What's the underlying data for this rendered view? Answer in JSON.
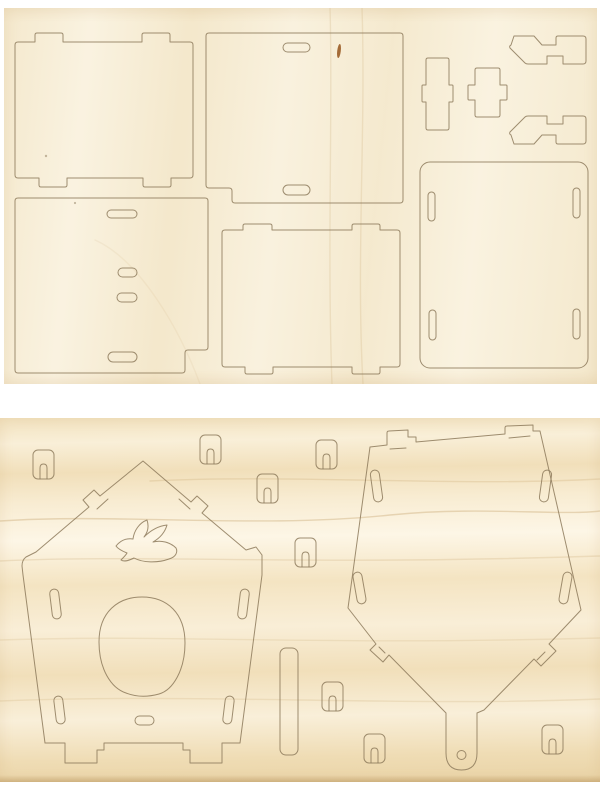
{
  "scene": {
    "type": "product-photo",
    "subject": "Laser-cut plywood birdhouse craft kit: two wooden punch-out sheets photographed on white",
    "sheet_count": 2,
    "visible_text": ""
  },
  "colors": {
    "page_bg": "#ffffff",
    "sheet_top_wood": "#f7eed8",
    "sheet_bottom_wood": "#f6e7c8",
    "grain_streak": "#c9a874",
    "cut_line": "#8d7a5c",
    "knot": "#9a5c26"
  },
  "sheets": [
    {
      "id": "top-sheet",
      "pieces": [
        {
          "name": "wall-panel-with-tabs-a",
          "position": "top-left"
        },
        {
          "name": "roof-panel-with-slots",
          "position": "top-middle",
          "detail": "two rounded slots, corner notch, small wood knot"
        },
        {
          "name": "cross-connector-a",
          "position": "top-right"
        },
        {
          "name": "cross-connector-b",
          "position": "top-right"
        },
        {
          "name": "ridge-bracket-a",
          "position": "far-top-right"
        },
        {
          "name": "ridge-bracket-b",
          "position": "far-right"
        },
        {
          "name": "wall-panel-with-four-slots",
          "position": "bottom-left"
        },
        {
          "name": "wall-panel-with-tabs-b",
          "position": "bottom-middle"
        },
        {
          "name": "base-panel-with-corner-slots",
          "position": "bottom-right"
        }
      ]
    },
    {
      "id": "bottom-sheet",
      "pieces": [
        {
          "name": "front-panel",
          "position": "left",
          "detail": "house-shaped, dove silhouette cutout, egg-shaped entry hole, roof tabs, feet"
        },
        {
          "name": "back-panel-with-hanger",
          "position": "right",
          "detail": "inverted house shape, hook tabs, hanging tail with round hole"
        },
        {
          "name": "perch-strip",
          "position": "center"
        },
        {
          "name": "lock-clip-1"
        },
        {
          "name": "lock-clip-2"
        },
        {
          "name": "lock-clip-3"
        },
        {
          "name": "lock-clip-4"
        },
        {
          "name": "lock-clip-5"
        },
        {
          "name": "lock-clip-6"
        },
        {
          "name": "lock-clip-7"
        },
        {
          "name": "lock-clip-8"
        }
      ]
    }
  ]
}
